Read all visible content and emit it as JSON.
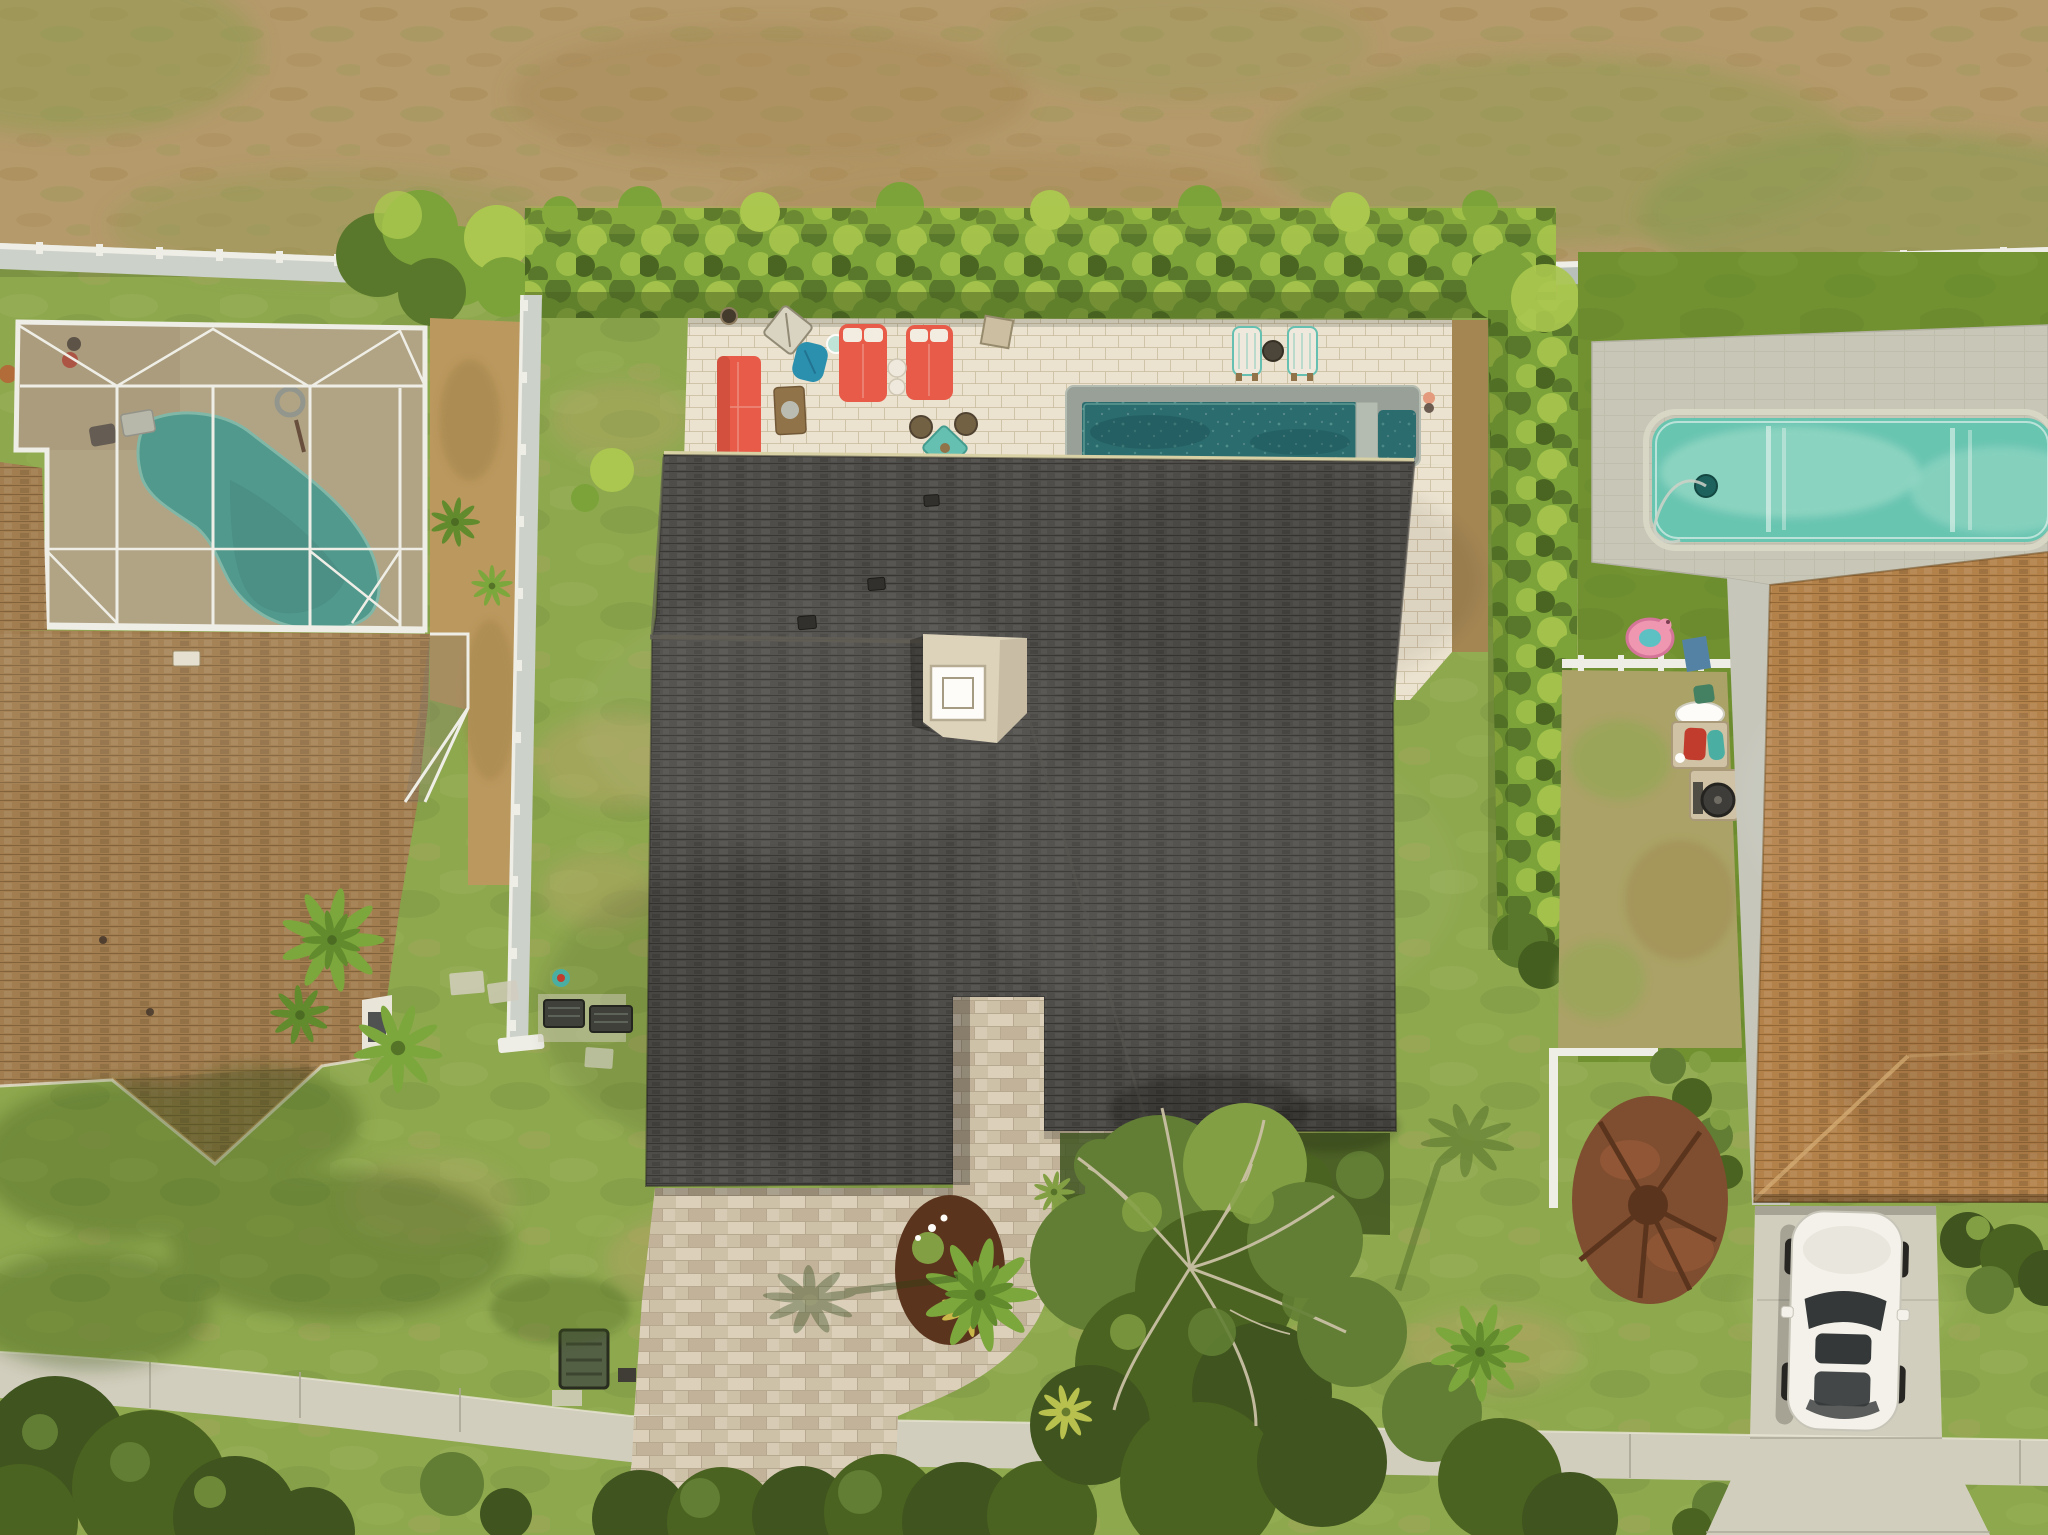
{
  "title": "Aerial drone photo of three suburban homes with pools, hedged backyard patio, paver driveway and street sidewalk",
  "palette": {
    "field": "#b49a6c",
    "fieldGreen": "#8e9a54",
    "fieldDark": "#a1854e",
    "lawn": "#8ba84e",
    "lawnLight": "#9fbb60",
    "lawnDry": "#b3a468",
    "lawnShadow": "#3d5a1e",
    "turf": "#6d9130",
    "turfDark": "#5c7f27",
    "hedge": "#79a338",
    "hedgeLight": "#a9c94f",
    "hedgeDark": "#55772a",
    "hedgeDeep": "#3f5c1e",
    "patio": "#ece5d4",
    "patioJoint": "#c9bda3",
    "paver": "#cdc2ac",
    "paverLight": "#dcd2bf",
    "paverDark": "#b5a78e",
    "concrete": "#d2d0c2",
    "concreteJoint": "#aaa898",
    "dirt": "#b9985f",
    "dirtDark": "#97793f",
    "fenceWhite": "#f0f1ec",
    "fencePanel": "#ccd3cf",
    "fencePanelShade": "#b7c1bd",
    "roofCenter": "#4a4a49",
    "roofLeft": "#a07c4f",
    "roofRight": "#b2804a",
    "poolDark": "#256a70",
    "poolDeep": "#10474e",
    "coping": "#96a09a",
    "copingLight": "#b3bcb4",
    "aqua": "#64c6b4",
    "aquaLight": "#a5e2d2",
    "deckTan": "#c6b894",
    "deckShade": "#af9f7c",
    "mesh": "#7d766a",
    "kidney": "#35a89e",
    "kidneyLight": "#7fd4c8",
    "chimney": "#ddd5bf",
    "chimneyShade": "#b4ab93",
    "gutter": "#d8d3a9",
    "mulch": "#7c4a2e",
    "mulchDark": "#57301b",
    "mulchRed": "#9a5a3a",
    "treeGreen": "#5d7d33",
    "treeLight": "#7fa043",
    "treeDark": "#46611f",
    "treeDeep": "#3a511d",
    "branchDry": "#c9c1a7",
    "palm": "#79a73c",
    "palmDark": "#5d8a2c",
    "coral": "#e85948",
    "coralDark": "#c04334",
    "wood": "#8d7148",
    "tealFurn": "#62c1b5",
    "blueChair": "#2590b2",
    "whiteFurn": "#efece1",
    "carBody": "#f4f4ef",
    "glass": "#2e3438",
    "grillRed": "#c0392b",
    "kayakTeal": "#45b0a5",
    "flamingo": "#f096b4",
    "walkGray": "#c5c8bf",
    "boxGreen": "#4f5e44",
    "stonePad": "#cfc3a8"
  },
  "scene": {
    "setting": "daytime aerial top-down view, sunny",
    "background_field": "dry tan grass field with green patches behind the properties",
    "left_property": {
      "house": "tan-brown shingle roof home",
      "pool_enclosure": "white aluminum screened lanai over concrete deck",
      "pool": "turquoise kidney-shaped pool",
      "yard_items": [
        "potted plants",
        "garden hose coil",
        "step platform"
      ]
    },
    "center_property": {
      "house": "large charcoal shingle roof home with cream chimney cap",
      "back_patio": "white paver patio behind the house",
      "patio_furniture": [
        "coral outdoor sofa",
        "wood coffee table",
        "blue butterfly chair",
        "two coral daybeds with white pillows",
        "white side tables",
        "teal dining table with four wicker chairs",
        "folded lounge chair",
        "fire bowl"
      ],
      "pool": "dark teal rectangular pool with spa and stone coping",
      "pool_chairs": "two white and teal deck chairs with round table",
      "hedge": "tall bright green privacy hedge wrapping the backyard",
      "driveway": "travertine paver driveway and entry walkway",
      "yard_items": [
        "generator box",
        "ac units",
        "agave",
        "palm trees",
        "mulch planting bed"
      ]
    },
    "right_property": {
      "house": "orange-brown shingle roof home",
      "back_yard": "dark green artificial turf",
      "pool": "light aqua rectangular pool with paver deck and pool cleaner",
      "side_yard_items": [
        "pink flamingo float",
        "white side fence with blue tarp",
        "lumber pile",
        "oval table",
        "planter with red and teal kid toys",
        "kettle grill"
      ],
      "front": [
        "white SUV on concrete driveway",
        "red mulch circle with dead stump",
        "foundation shrubs",
        "white corner fence"
      ]
    },
    "street": "concrete sidewalk crossing the bottom with lawns, large tree canopy with dry branches, palms and tree clusters"
  }
}
